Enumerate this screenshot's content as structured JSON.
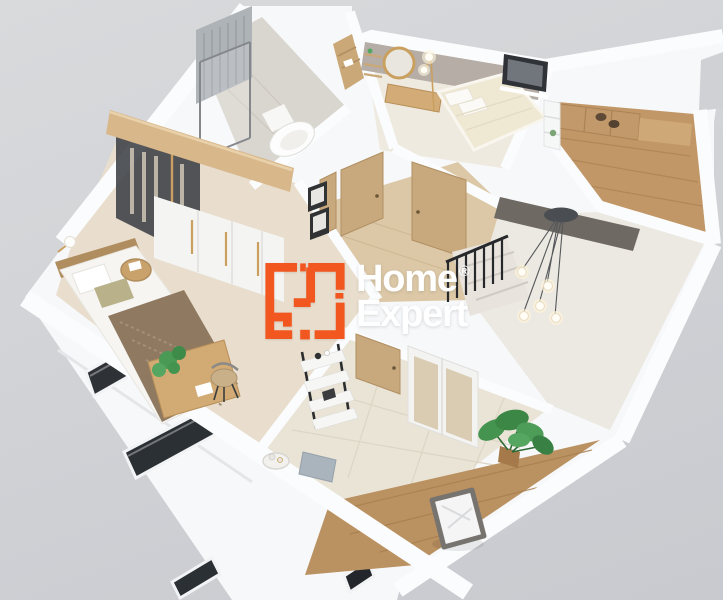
{
  "watermark": {
    "brand": {
      "word_top": "Home",
      "word_bottom": "Expert",
      "registered_mark": "®"
    },
    "icon_name": "floorplan-logo-icon",
    "colors": {
      "accent_orange": "#F2571F",
      "text_white": "#FFFFFF"
    }
  },
  "scene": {
    "description": "3D isometric cutaway render of an apartment upper floor plan",
    "background_color": "#CFD1D5",
    "palette": {
      "wall_white": "#F7F8FA",
      "wood_floor": "#C29768",
      "light_wood_cap": "#D8B78A",
      "tile_floor": "#EAE4D7",
      "blush_floor": "#E9DECD",
      "door_tan": "#C8A87D",
      "greige_wall": "#B5ADA6",
      "dark_glass": "#2E3237",
      "stair_void": "#6E6963",
      "plant_green": "#44934F",
      "railing_black": "#26282B",
      "gold": "#C9A05F"
    },
    "objects": [
      "shower-enclosure",
      "toilet",
      "bathroom-towel-shelf",
      "walk-in-wardrobe-glass",
      "wardrobe-doors",
      "wall-lamp",
      "double-bed-with-throw",
      "bedside-table",
      "desk-with-chair",
      "desk-plant",
      "round-wall-mirror",
      "wall-shelves",
      "vanity-console",
      "gold-floor-lamp",
      "cream-double-bed",
      "bedroom-window",
      "kitchen-cabinets",
      "cooktop-burners",
      "kitchen-shelf-unit",
      "corridor-doors",
      "picture-frames",
      "staircase-railing",
      "stair-steps",
      "stairwell-void",
      "pendant-chandelier",
      "hallway-door",
      "hallway-wardrobe",
      "ladder-shelf",
      "serving-tray",
      "pouf",
      "laundry-basket",
      "monstera-plant",
      "facade-windows"
    ]
  }
}
